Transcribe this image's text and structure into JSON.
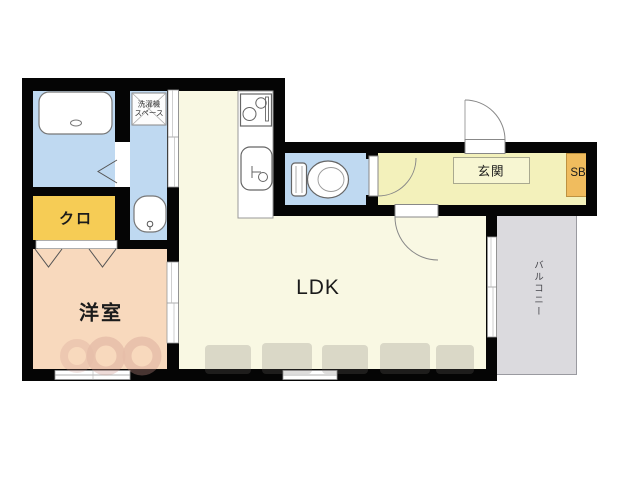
{
  "title": "apartment-floor-plan",
  "rooms": {
    "washer_space": {
      "label": "洗濯機\nスペース"
    },
    "closet": {
      "label": "クロ"
    },
    "western_room": {
      "label": "洋室"
    },
    "ldk": {
      "label": "LDK"
    },
    "entrance": {
      "label": "玄関"
    },
    "shoe_box": {
      "label": "SB"
    },
    "balcony": {
      "label": "バルコニー"
    }
  },
  "fixtures": {
    "bathtub": "rounded-rect-with-drain",
    "washing_machine_space": "crossed-box",
    "washbasin": "oval-basin-with-faucet",
    "stove": "two-burner-cooktop",
    "kitchen_sink": "rounded-sink-with-faucet",
    "toilet": "tank-and-bowl",
    "doors": "quarter-arc-swing-doors, sliding-doors, folding-chevron-doors",
    "windows": "double-line-sliding-windows"
  },
  "colors": {
    "wall": "#050505",
    "water_rooms_blue": "#bfd9f1",
    "ldk_cream": "#f9f8e3",
    "corridor_yellow": "#f3f1bb",
    "genkan_step": "#f7f6d2",
    "closet_yellow": "#f6cc55",
    "shoe_box_orange": "#f0bc5e",
    "western_room_peach": "#f8d9bd",
    "balcony_gray": "#dbdade"
  }
}
